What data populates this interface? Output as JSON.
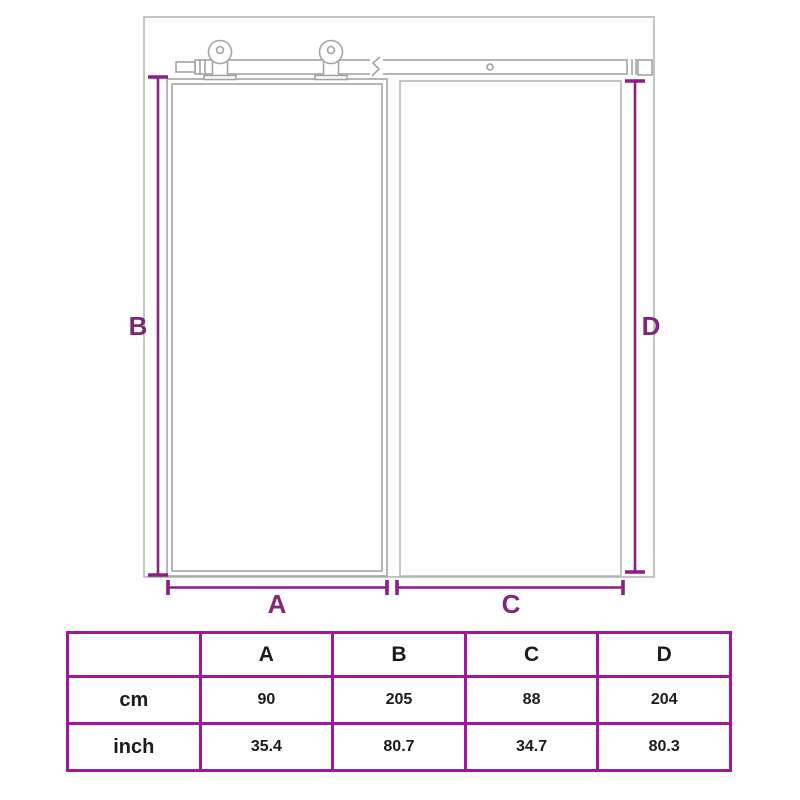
{
  "diagram": {
    "dim_labels": {
      "a": "A",
      "b": "B",
      "c": "C",
      "d": "D"
    },
    "parts": [
      "wall-outline",
      "doorway-opening",
      "sliding-door-panel",
      "sliding-rail",
      "roller-hanger-left",
      "roller-hanger-right"
    ],
    "colors": {
      "dimension_line": "#8e1d85",
      "dimension_label": "#7e2777",
      "outline_gray": "#b6b6b6",
      "hardware_gray": "#a4a4a4"
    }
  },
  "table": {
    "col_headers": [
      "A",
      "B",
      "C",
      "D"
    ],
    "rows": [
      {
        "label": "cm",
        "values": [
          "90",
          "205",
          "88",
          "204"
        ]
      },
      {
        "label": "inch",
        "values": [
          "35.4",
          "80.7",
          "34.7",
          "80.3"
        ]
      }
    ],
    "border_color": "#a2169c"
  }
}
